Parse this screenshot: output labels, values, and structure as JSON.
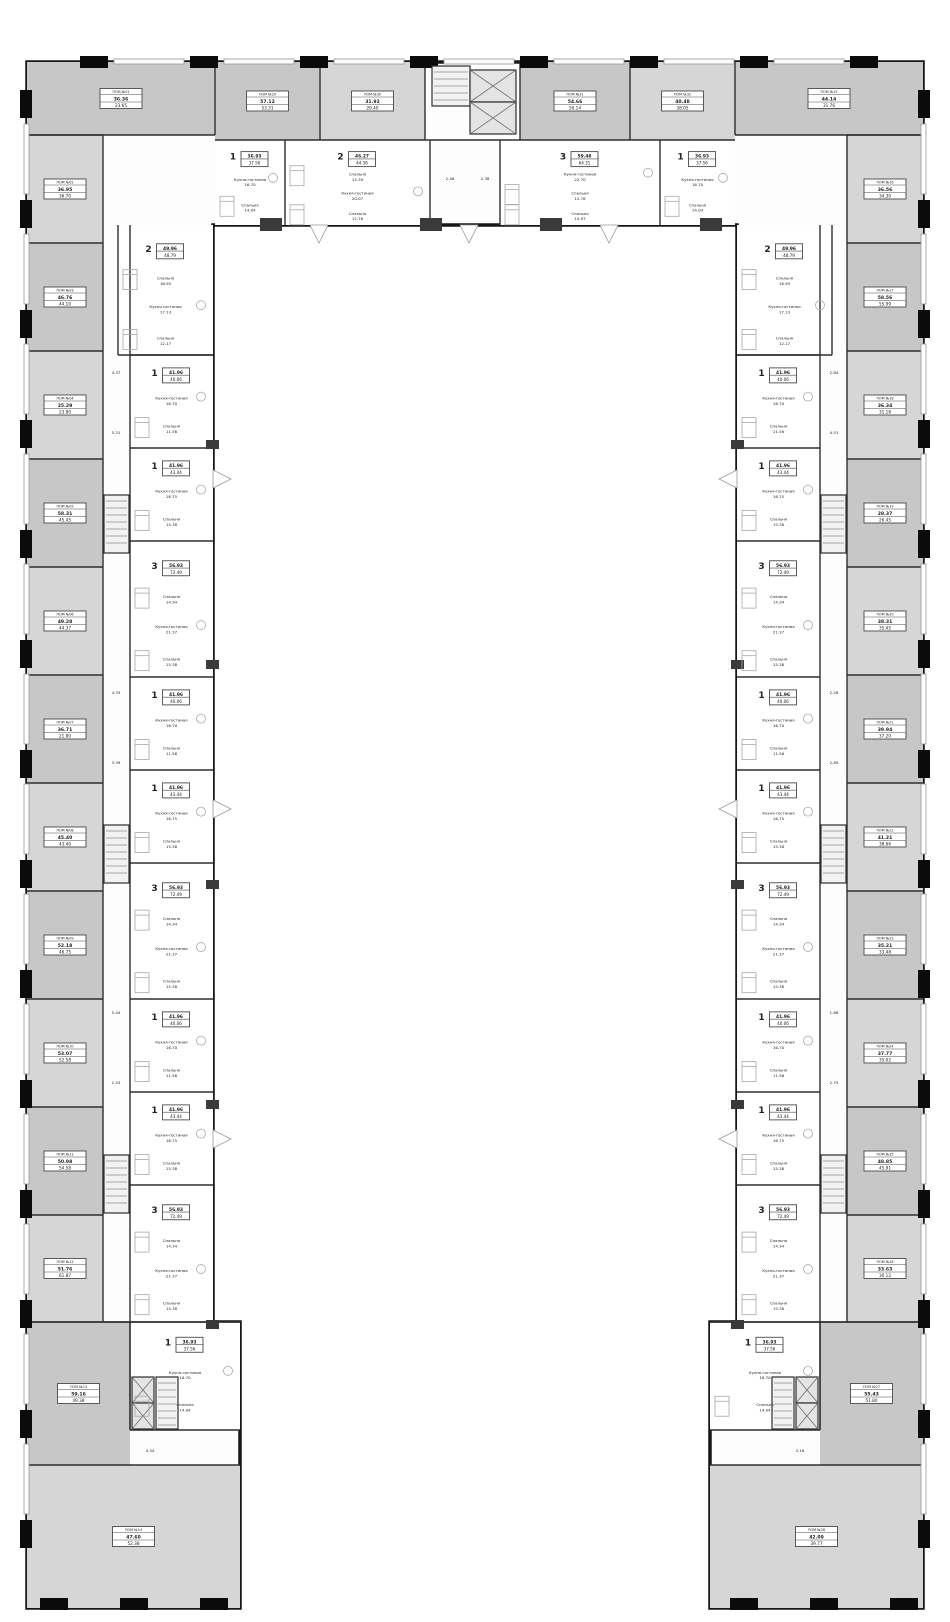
{
  "plan": {
    "kind": "residential-floor-plan",
    "shape": "u-shaped-building"
  },
  "palette": {
    "background": "#ffffff",
    "wall": "#161616",
    "pier": "#0b0b0b",
    "partition": "#2e2e2e",
    "commercial_fill": "#d6d6d6",
    "commercial_fill_alt": "#c7c7c7",
    "apartment_fill": "#ffffff",
    "furniture_line": "#a8a8a8",
    "window_line": "#979797",
    "label_border": "#4a4a4a",
    "text": "#222222"
  },
  "icons": {
    "elevator": "crossed-box",
    "stairs": "hatched-steps",
    "window_swing": "white-wedge"
  },
  "room_names": [
    "Кухня-гостиная",
    "Спальня"
  ],
  "units": {
    "commercial": [
      {
        "id": "ПОМ №01",
        "area_1": "36.36",
        "area_2": "23.65"
      },
      {
        "id": "ПОМ №02",
        "area_1": "36.95",
        "area_2": "36.70"
      },
      {
        "id": "ПОМ №03",
        "area_1": "46.76",
        "area_2": "44.10"
      },
      {
        "id": "ПОМ №04",
        "area_1": "25.29",
        "area_2": "23.80"
      },
      {
        "id": "ПОМ №05",
        "area_1": "58.31",
        "area_2": "45.45"
      },
      {
        "id": "ПОМ №06",
        "area_1": "49.28",
        "area_2": "44.37"
      },
      {
        "id": "ПОМ №07",
        "area_1": "36.71",
        "area_2": "21.80"
      },
      {
        "id": "ПОМ №08",
        "area_1": "45.40",
        "area_2": "43.40"
      },
      {
        "id": "ПОМ №09",
        "area_1": "52.18",
        "area_2": "46.75"
      },
      {
        "id": "ПОМ №10",
        "area_1": "53.07",
        "area_2": "52.58"
      },
      {
        "id": "ПОМ №11",
        "area_1": "50.98",
        "area_2": "54.58"
      },
      {
        "id": "ПОМ №12",
        "area_1": "51.76",
        "area_2": "61.87"
      },
      {
        "id": "ПОМ №13",
        "area_1": "59.16",
        "area_2": "49.38"
      },
      {
        "id": "ПОМ №14",
        "area_1": "47.60",
        "area_2": "52.38"
      },
      {
        "id": "ПОМ №15",
        "area_1": "44.14",
        "area_2": "31.76"
      },
      {
        "id": "ПОМ №16",
        "area_1": "36.56",
        "area_2": "34.30"
      },
      {
        "id": "ПОМ №17",
        "area_1": "58.56",
        "area_2": "55.99"
      },
      {
        "id": "ПОМ №18",
        "area_1": "36.34",
        "area_2": "31.18"
      },
      {
        "id": "ПОМ №19",
        "area_1": "28.37",
        "area_2": "26.45"
      },
      {
        "id": "ПОМ №20",
        "area_1": "38.31",
        "area_2": "35.45"
      },
      {
        "id": "ПОМ №21",
        "area_1": "39.94",
        "area_2": "37.20"
      },
      {
        "id": "ПОМ №22",
        "area_1": "41.21",
        "area_2": "38.66"
      },
      {
        "id": "ПОМ №23",
        "area_1": "35.21",
        "area_2": "33.48"
      },
      {
        "id": "ПОМ №24",
        "area_1": "37.77",
        "area_2": "35.02"
      },
      {
        "id": "ПОМ №25",
        "area_1": "48.85",
        "area_2": "45.91"
      },
      {
        "id": "ПОМ №26",
        "area_1": "33.63",
        "area_2": "30.12"
      },
      {
        "id": "ПОМ №27",
        "area_1": "55.43",
        "area_2": "51.80"
      },
      {
        "id": "ПОМ №28",
        "area_1": "42.09",
        "area_2": "39.77"
      },
      {
        "id": "ПОМ №29",
        "area_1": "57.12",
        "area_2": "53.31"
      },
      {
        "id": "ПОМ №30",
        "area_1": "31.92",
        "area_2": "29.40"
      },
      {
        "id": "ПОМ №31",
        "area_1": "54.66",
        "area_2": "50.14"
      },
      {
        "id": "ПОМ №32",
        "area_1": "40.48",
        "area_2": "38.05"
      }
    ],
    "apartments": [
      {
        "type": "1",
        "area_total": "36.93",
        "area_living": "37.56",
        "rooms": [
          {
            "name": "Кухня-гостиная",
            "area": "16.70"
          },
          {
            "name": "Спальня",
            "area": "14.04"
          }
        ]
      },
      {
        "type": "2",
        "area_total": "46.27",
        "area_living": "44.36",
        "rooms": [
          {
            "name": "Спальня",
            "area": "15.39"
          },
          {
            "name": "Кухня-гостиная",
            "area": "20.07"
          },
          {
            "name": "Спальня",
            "area": "12.76"
          }
        ]
      },
      {
        "type": "3",
        "area_total": "59.48",
        "area_living": "64.31",
        "rooms": [
          {
            "name": "Кухня-гостиная",
            "area": "22.70"
          },
          {
            "name": "Спальня",
            "area": "12.78"
          },
          {
            "name": "Спальня",
            "area": "14.97"
          }
        ]
      },
      {
        "type": "1",
        "area_total": "36.93",
        "area_living": "37.56",
        "rooms": [
          {
            "name": "Кухня-гостиная",
            "area": "16.70"
          },
          {
            "name": "Спальня",
            "area": "14.04"
          }
        ]
      },
      {
        "type": "2",
        "area_total": "49.96",
        "area_living": "48.79",
        "rooms": [
          {
            "name": "Спальня",
            "area": "16.95"
          },
          {
            "name": "Кухня-гостиная",
            "area": "17.13"
          },
          {
            "name": "Спальня",
            "area": "12.17"
          }
        ]
      },
      {
        "type": "1",
        "area_total": "41.96",
        "area_living": "40.06",
        "rooms": [
          {
            "name": "Кухня-гостиная",
            "area": "16.70"
          },
          {
            "name": "Спальня",
            "area": "11.56"
          }
        ]
      },
      {
        "type": "1",
        "area_total": "41.96",
        "area_living": "43.44",
        "rooms": [
          {
            "name": "Кухня-гостиная",
            "area": "16.75"
          },
          {
            "name": "Спальня",
            "area": "15.38"
          }
        ]
      },
      {
        "type": "3",
        "area_total": "56.93",
        "area_living": "72.49",
        "rooms": [
          {
            "name": "Спальня",
            "area": "14.34"
          },
          {
            "name": "Кухня-гостиная",
            "area": "21.37"
          },
          {
            "name": "Спальня",
            "area": "15.38"
          }
        ]
      },
      {
        "type": "1",
        "area_total": "41.96",
        "area_living": "40.06",
        "rooms": [
          {
            "name": "Кухня-гостиная",
            "area": "16.70"
          },
          {
            "name": "Спальня",
            "area": "11.56"
          }
        ]
      },
      {
        "type": "1",
        "area_total": "41.96",
        "area_living": "43.44",
        "rooms": [
          {
            "name": "Кухня-гостиная",
            "area": "16.75"
          },
          {
            "name": "Спальня",
            "area": "15.38"
          }
        ]
      },
      {
        "type": "3",
        "area_total": "56.93",
        "area_living": "72.49",
        "rooms": [
          {
            "name": "Спальня",
            "area": "14.34"
          },
          {
            "name": "Кухня-гостиная",
            "area": "21.37"
          },
          {
            "name": "Спальня",
            "area": "15.38"
          }
        ]
      },
      {
        "type": "1",
        "area_total": "41.96",
        "area_living": "40.06",
        "rooms": [
          {
            "name": "Кухня-гостиная",
            "area": "16.70"
          },
          {
            "name": "Спальня",
            "area": "11.56"
          }
        ]
      },
      {
        "type": "1",
        "area_total": "41.96",
        "area_living": "43.44",
        "rooms": [
          {
            "name": "Кухня-гостиная",
            "area": "16.75"
          },
          {
            "name": "Спальня",
            "area": "15.38"
          }
        ]
      },
      {
        "type": "3",
        "area_total": "56.93",
        "area_living": "72.49",
        "rooms": [
          {
            "name": "Спальня",
            "area": "14.34"
          },
          {
            "name": "Кухня-гостиная",
            "area": "21.37"
          },
          {
            "name": "Спальня",
            "area": "15.38"
          }
        ]
      },
      {
        "type": "1",
        "area_total": "36.93",
        "area_living": "37.56",
        "rooms": [
          {
            "name": "Кухня-гостиная",
            "area": "16.70"
          },
          {
            "name": "Спальня",
            "area": "14.04"
          }
        ]
      },
      {
        "type": "2",
        "area_total": "49.96",
        "area_living": "48.79",
        "rooms": [
          {
            "name": "Спальня",
            "area": "16.95"
          },
          {
            "name": "Кухня-гостиная",
            "area": "17.13"
          },
          {
            "name": "Спальня",
            "area": "12.17"
          }
        ]
      },
      {
        "type": "1",
        "area_total": "41.96",
        "area_living": "40.06",
        "rooms": [
          {
            "name": "Кухня-гостиная",
            "area": "16.70"
          },
          {
            "name": "Спальня",
            "area": "11.56"
          }
        ]
      },
      {
        "type": "1",
        "area_total": "41.96",
        "area_living": "43.44",
        "rooms": [
          {
            "name": "Кухня-гостиная",
            "area": "16.75"
          },
          {
            "name": "Спальня",
            "area": "15.38"
          }
        ]
      },
      {
        "type": "3",
        "area_total": "56.93",
        "area_living": "72.49",
        "rooms": [
          {
            "name": "Спальня",
            "area": "14.34"
          },
          {
            "name": "Кухня-гостиная",
            "area": "21.37"
          },
          {
            "name": "Спальня",
            "area": "15.38"
          }
        ]
      },
      {
        "type": "1",
        "area_total": "41.96",
        "area_living": "40.06",
        "rooms": [
          {
            "name": "Кухня-гостиная",
            "area": "16.70"
          },
          {
            "name": "Спальня",
            "area": "11.56"
          }
        ]
      },
      {
        "type": "1",
        "area_total": "41.96",
        "area_living": "43.44",
        "rooms": [
          {
            "name": "Кухня-гостиная",
            "area": "16.75"
          },
          {
            "name": "Спальня",
            "area": "15.38"
          }
        ]
      },
      {
        "type": "3",
        "area_total": "56.93",
        "area_living": "72.49",
        "rooms": [
          {
            "name": "Спальня",
            "area": "14.34"
          },
          {
            "name": "Кухня-гостиная",
            "area": "21.37"
          },
          {
            "name": "Спальня",
            "area": "15.38"
          }
        ]
      },
      {
        "type": "1",
        "area_total": "41.96",
        "area_living": "40.06",
        "rooms": [
          {
            "name": "Кухня-гостиная",
            "area": "16.70"
          },
          {
            "name": "Спальня",
            "area": "11.56"
          }
        ]
      },
      {
        "type": "1",
        "area_total": "41.96",
        "area_living": "43.44",
        "rooms": [
          {
            "name": "Кухня-гостиная",
            "area": "16.75"
          },
          {
            "name": "Спальня",
            "area": "15.38"
          }
        ]
      },
      {
        "type": "3",
        "area_total": "56.93",
        "area_living": "72.49",
        "rooms": [
          {
            "name": "Спальня",
            "area": "14.34"
          },
          {
            "name": "Кухня-гостиная",
            "area": "21.37"
          },
          {
            "name": "Спальня",
            "area": "15.38"
          }
        ]
      },
      {
        "type": "1",
        "area_total": "36.93",
        "area_living": "37.56",
        "rooms": [
          {
            "name": "Кухня-гостиная",
            "area": "16.70"
          },
          {
            "name": "Спальня",
            "area": "14.04"
          }
        ]
      }
    ]
  },
  "misc_areas": [
    "4.37",
    "5.31",
    "4.33",
    "3.39",
    "5.44",
    "2.43",
    "2.84",
    "4.51",
    "2.28",
    "2.89",
    "1.68",
    "2.75",
    "2.46",
    "2.38",
    "4.34",
    "3.16"
  ]
}
